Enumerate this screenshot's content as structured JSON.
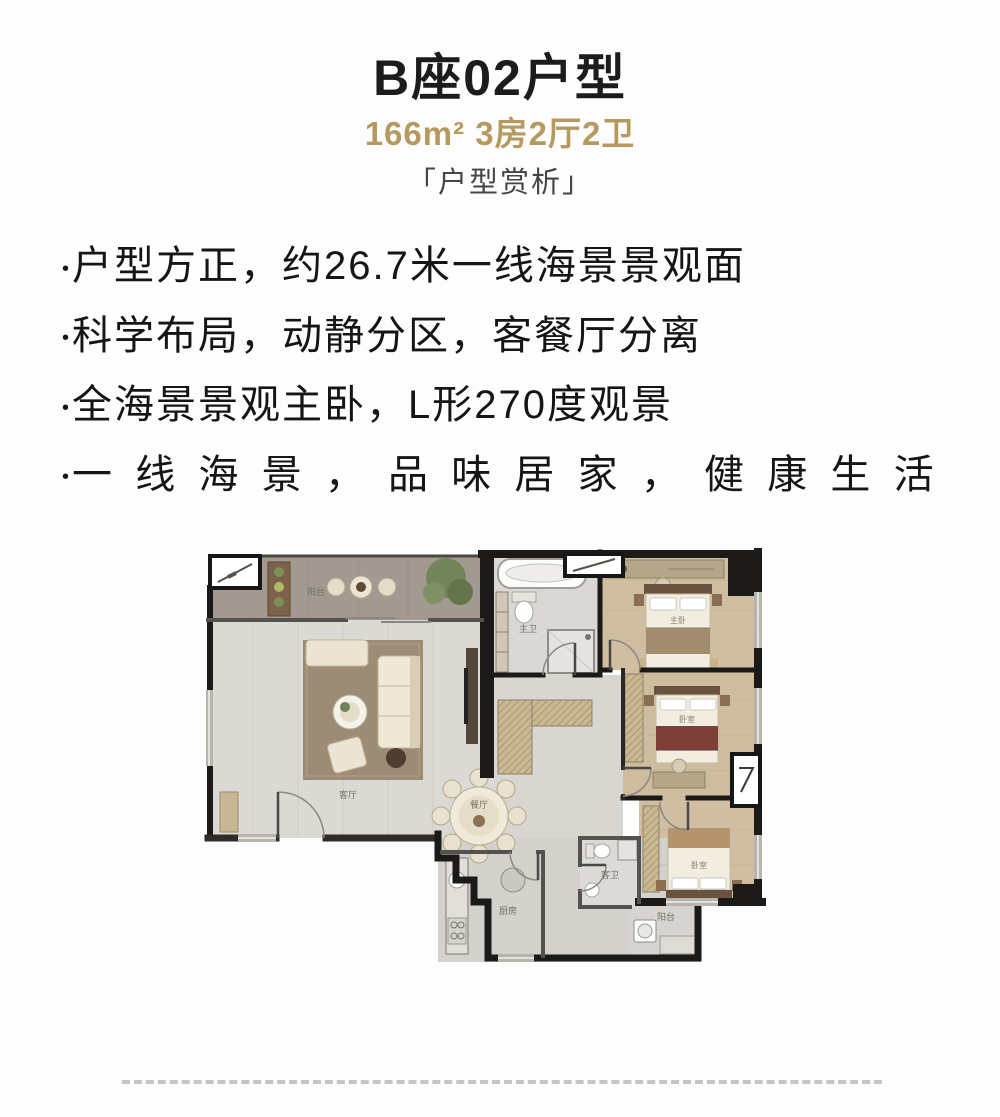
{
  "header": {
    "title": "B座02户型",
    "specs": "166m² 3房2厅2卫",
    "section_label": "「户型赏析」"
  },
  "bullets": [
    {
      "marker": "•",
      "text": "户型方正，约26.7米一线海景景观面"
    },
    {
      "marker": "•",
      "text": "科学布局，动静分区，客餐厅分离"
    },
    {
      "marker": "•",
      "text": "全海景景观主卧，L形270度观景"
    },
    {
      "marker": "•",
      "text": "一线海景，品味居家，健康生活"
    }
  ],
  "floorplan": {
    "labels": {
      "balcony": "阳台",
      "living": "客厅",
      "dining": "餐厅",
      "master_bath": "主卫",
      "master_bedroom": "主卧",
      "bedroom2": "卧室",
      "bedroom3": "卧室",
      "kitchen": "厨房",
      "guest_bath": "客卫",
      "service_balcony": "阳台"
    }
  },
  "colors": {
    "accent_gold": "#b5995f",
    "title_color": "#1c1c1c",
    "body_text": "#151515",
    "divider": "#c6c5c5",
    "wall_black": "#1b1a18",
    "wood_floor": "#cfbea1",
    "tile_floor": "#dbd9d4"
  }
}
